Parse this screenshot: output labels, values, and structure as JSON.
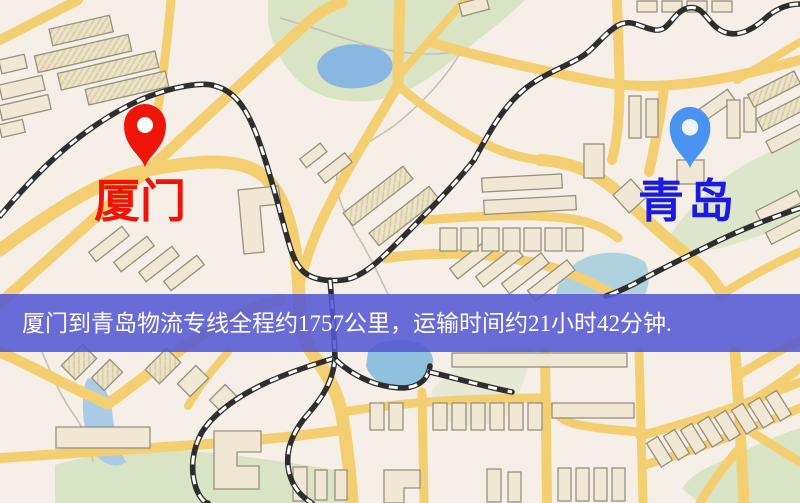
{
  "banner": {
    "text": "厦门到青岛物流专线全程约1757公里，运输时间约21小时42分钟.",
    "bg": "#5457d3",
    "text_color": "#ffffff"
  },
  "markers": {
    "origin": {
      "label": "厦门",
      "pin_color": "#f01509",
      "label_color": "#ee1408"
    },
    "destination": {
      "label": "青岛",
      "pin_color": "#4b93f0",
      "label_color": "#1a1ae0"
    }
  },
  "colors": {
    "map_background": "#f6efe8",
    "road": "#f3cf72",
    "park": "#d8e4c4",
    "water": "#8ab7e2",
    "building": "#f0e8d4",
    "building_outline": "#97907b",
    "railway_dark": "#2e2e2e",
    "railway_light": "#ffffff"
  }
}
